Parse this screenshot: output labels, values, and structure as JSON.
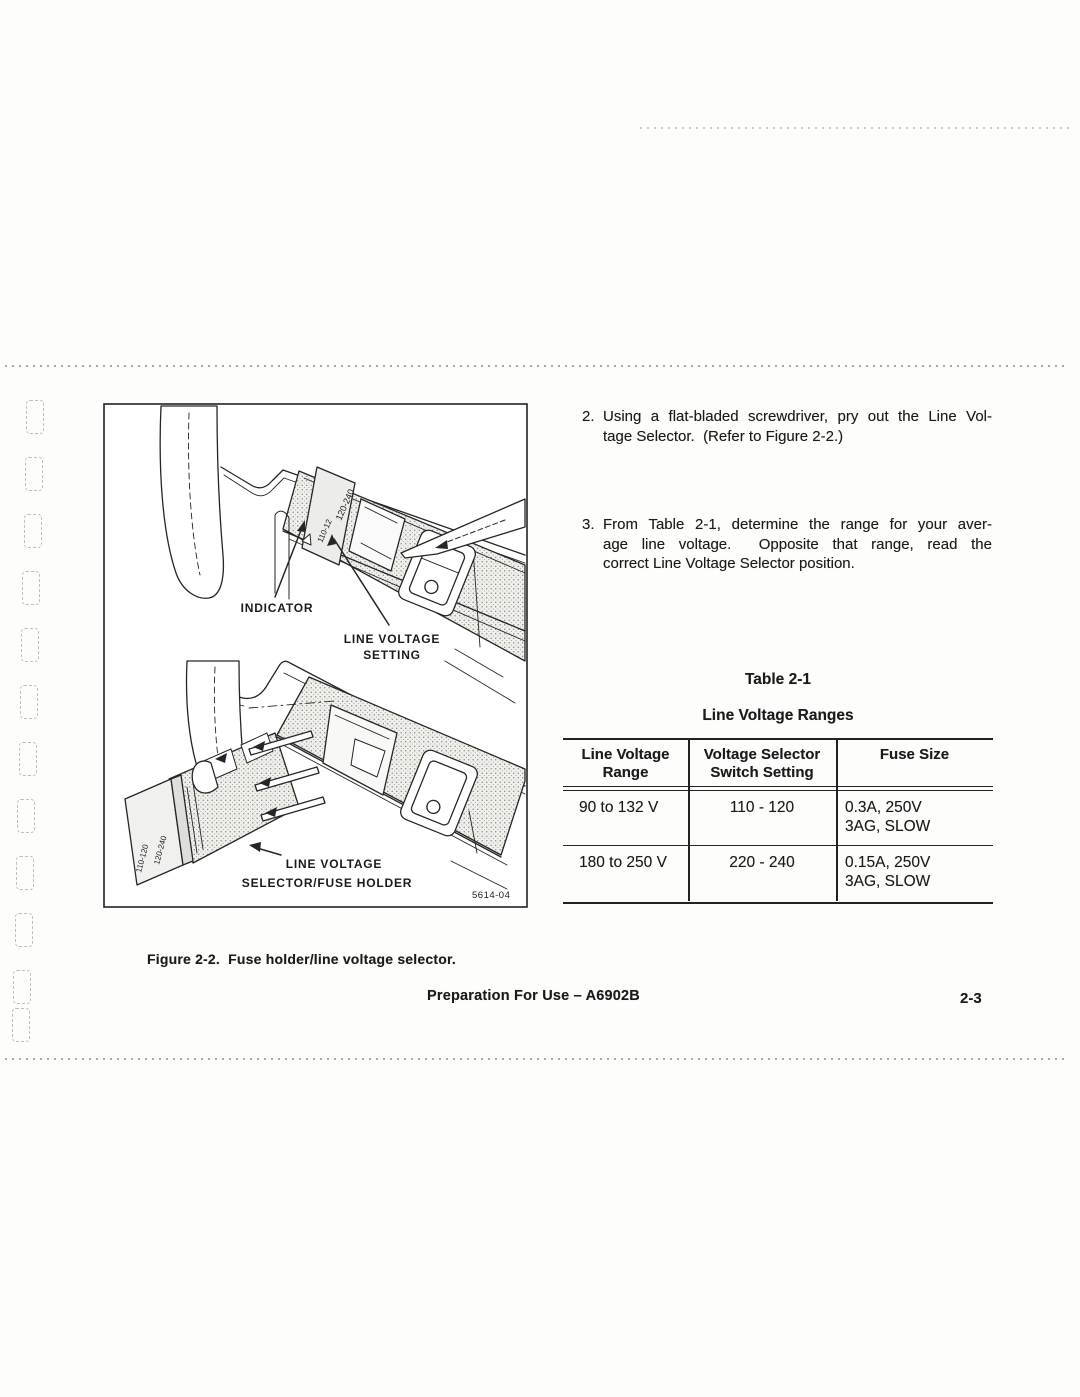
{
  "page": {
    "footer_text": "Preparation For Use – A6902B",
    "page_number": "2-3"
  },
  "instructions": {
    "item2": {
      "number": "2.",
      "lines": [
        "Using a flat-bladed screwdriver, pry out the Line Vol-",
        "tage Selector.  (Refer to Figure 2-2.)"
      ]
    },
    "item3": {
      "number": "3.",
      "lines": [
        "From Table 2-1, determine the range for your aver-",
        "age line voltage.  Opposite that range, read the",
        "correct Line Voltage Selector position."
      ]
    }
  },
  "figure": {
    "caption": "Figure 2-2.  Fuse holder/line voltage selector.",
    "part_number": "5614-04",
    "labels": {
      "indicator": "INDICATOR",
      "setting_line1": "LINE VOLTAGE",
      "setting_line2": "SETTING",
      "holder_line1": "LINE VOLTAGE",
      "holder_line2": "SELECTOR/FUSE HOLDER",
      "selector_marking_a": "120-240",
      "selector_marking_b": "110-12",
      "holder_marking_a": "120-240",
      "holder_marking_b": "110-120"
    }
  },
  "table": {
    "title": "Table 2-1",
    "subtitle": "Line Voltage Ranges",
    "headers": {
      "col1_line1": "Line Voltage",
      "col1_line2": "Range",
      "col2_line1": "Voltage Selector",
      "col2_line2": "Switch Setting",
      "col3_line1": "Fuse Size"
    },
    "rows": [
      {
        "range": "90 to 132 V",
        "setting": "110 - 120",
        "fuse_line1": "0.3A, 250V",
        "fuse_line2": "3AG, SLOW"
      },
      {
        "range": "180 to 250 V",
        "setting": "220 - 240",
        "fuse_line1": "0.15A, 250V",
        "fuse_line2": "3AG, SLOW"
      }
    ]
  }
}
